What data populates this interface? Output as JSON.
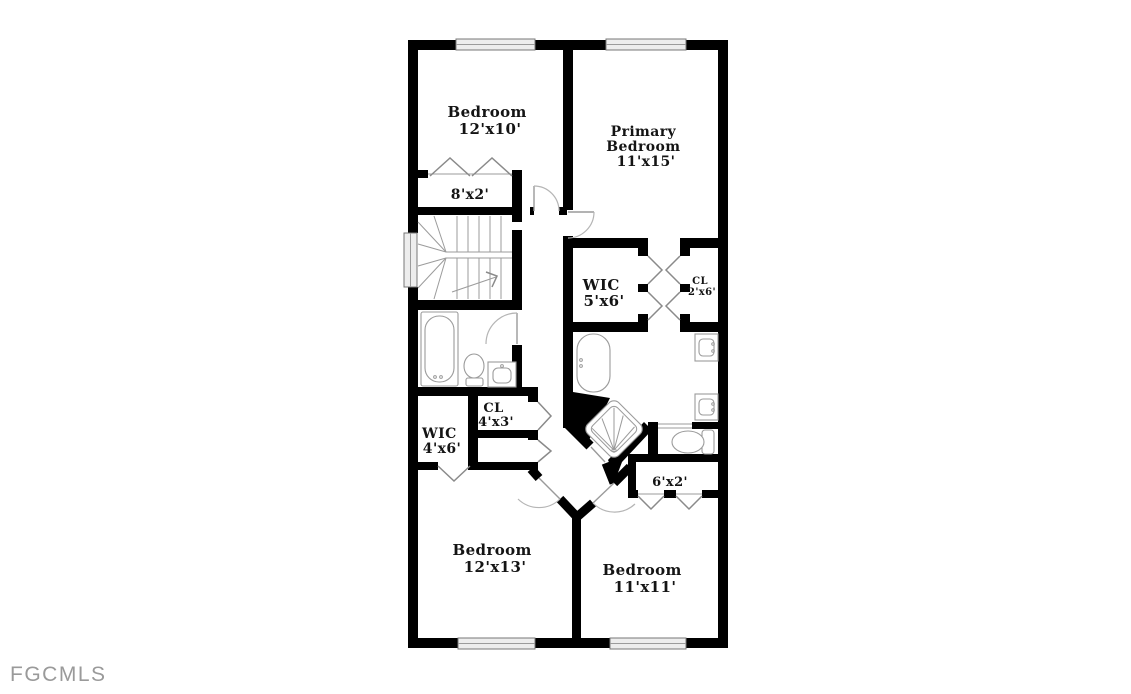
{
  "watermark": "FGCMLS",
  "colors": {
    "background": "#ffffff",
    "wall": "#000000",
    "fixture_line": "#9b9b9b",
    "door_arc": "#b5b5b5",
    "label": "#141414",
    "window_fill": "#ededed",
    "watermark": "#9a9a9a"
  },
  "rooms": {
    "bedroom_top_left": {
      "name": "Bedroom",
      "dims": "12'x10'"
    },
    "primary_bedroom": {
      "name_line1": "Primary",
      "name_line2": "Bedroom",
      "dims": "11'x15'"
    },
    "closet_top": {
      "dims": "8'x2'"
    },
    "wic_primary": {
      "name": "WIC",
      "dims": "5'x6'"
    },
    "closet_primary": {
      "name": "CL",
      "dims": "2'x6'"
    },
    "closet_hall": {
      "name": "CL",
      "dims": "4'x3'"
    },
    "wic_left": {
      "name": "WIC",
      "dims": "4'x6'"
    },
    "closet_bottom_right": {
      "dims": "6'x2'"
    },
    "bedroom_bottom_left": {
      "name": "Bedroom",
      "dims": "12'x13'"
    },
    "bedroom_bottom_right": {
      "name": "Bedroom",
      "dims": "11'x11'"
    }
  }
}
